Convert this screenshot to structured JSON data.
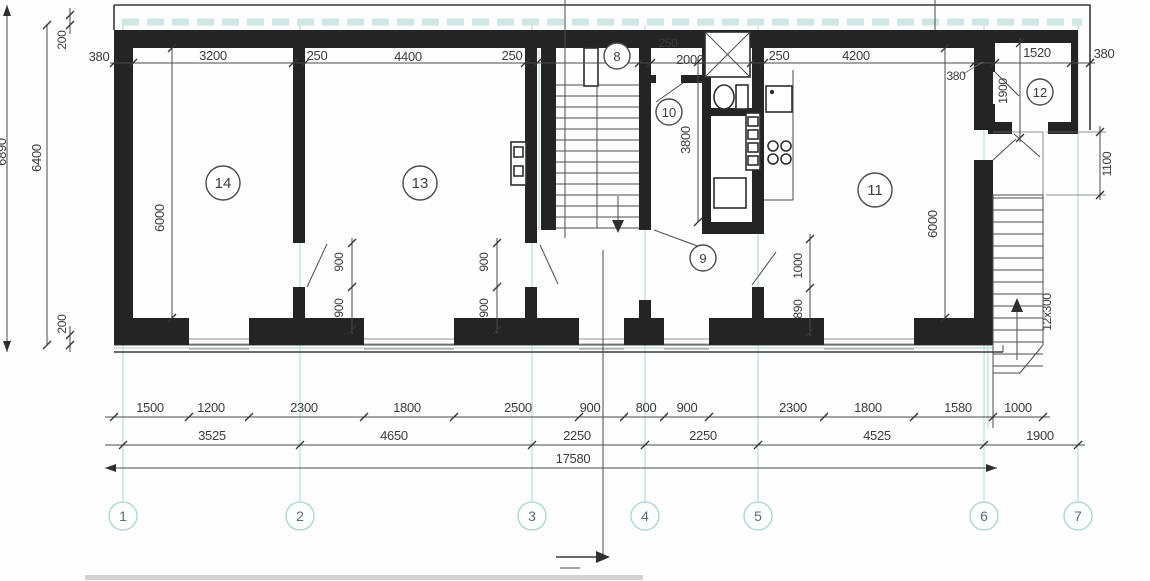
{
  "drawing": {
    "kind": "apartment-floor-plan",
    "units": "mm"
  },
  "rooms": [
    "14",
    "13",
    "8",
    "10",
    "9",
    "11",
    "12"
  ],
  "axes": [
    "1",
    "2",
    "3",
    "4",
    "5",
    "6",
    "7"
  ],
  "dims": {
    "top": [
      "380",
      "3200",
      "250",
      "4400",
      "250",
      "250",
      "2000",
      "250",
      "4200",
      "380",
      "1520",
      "380"
    ],
    "left": [
      "6890",
      "200",
      "6400",
      "200"
    ],
    "interior": [
      "6000",
      "900",
      "900",
      "900",
      "900",
      "3800",
      "1000",
      "890",
      "6000",
      "1900",
      "1100"
    ],
    "stair_note": "12x300",
    "row1": [
      "1500",
      "1200",
      "2300",
      "1800",
      "2500",
      "900",
      "800",
      "900",
      "2300",
      "1800",
      "1580",
      "1000"
    ],
    "row2": [
      "3525",
      "4650",
      "2250",
      "2250",
      "4525",
      "1900"
    ],
    "total": "17580"
  }
}
